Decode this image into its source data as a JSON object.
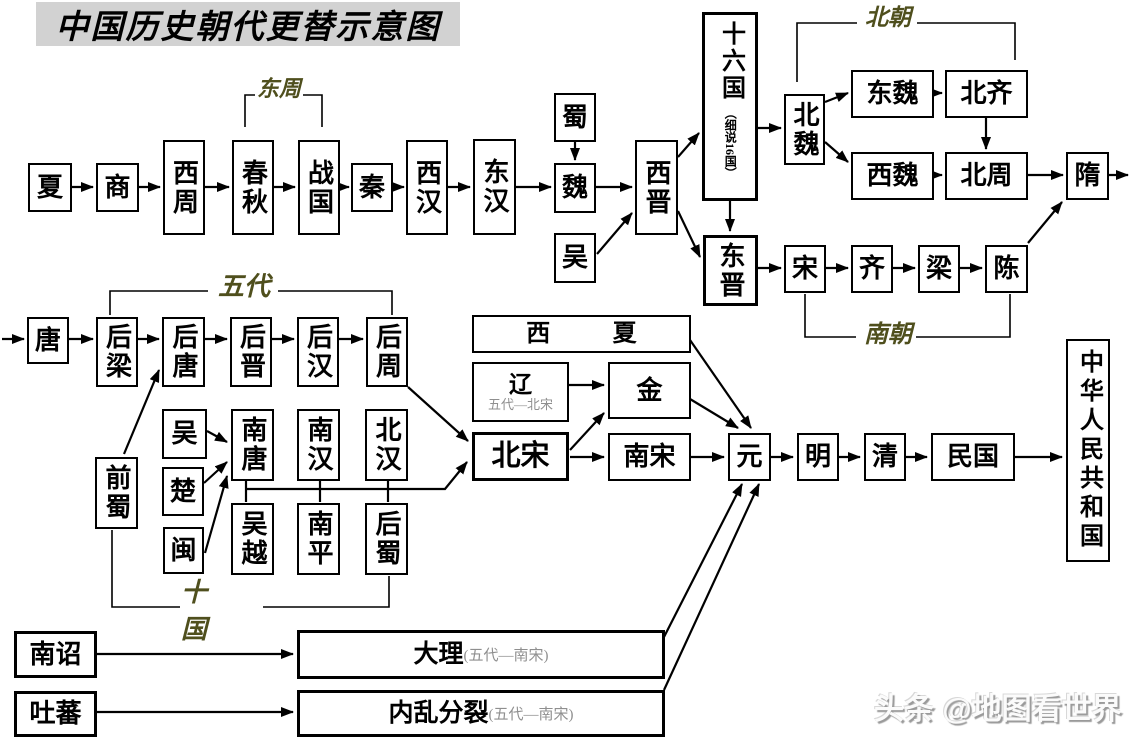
{
  "title": "中国历史朝代更替示意图",
  "watermark": "头条 @地图看世界",
  "era_labels": {
    "dongzhou": "东周",
    "beichao": "北朝",
    "nanchao": "南朝",
    "wudai": "五代",
    "shiguo": "十 国"
  },
  "nodes": {
    "xia": "夏",
    "shang": "商",
    "xizhou": "西周",
    "chunqiu": "春秋",
    "zhanguo": "战国",
    "qin": "秦",
    "xihan": "西汉",
    "donghan": "东汉",
    "shu": "蜀",
    "wei": "魏",
    "wu_sanguo": "吴",
    "xijin": "西晋",
    "shiliuguo": {
      "main": "十六国",
      "note": "（细说16国）"
    },
    "beiwei": "北魏",
    "dongwei": "东魏",
    "beiqi": "北齐",
    "xiwei": "西魏",
    "beizhou": "北周",
    "sui": "隋",
    "dongjin": "东晋",
    "song": "宋",
    "qi": "齐",
    "liang": "梁",
    "chen": "陈",
    "tang": "唐",
    "houliang": "后梁",
    "houtang": "后唐",
    "houjin": "后晋",
    "houhan": "后汉",
    "houzhou": "后周",
    "qianshu": "前蜀",
    "wu_shiguo": "吴",
    "chu": "楚",
    "min": "闽",
    "nantang": "南唐",
    "nanhan": "南汉",
    "beihan": "北汉",
    "wuyue": "吴越",
    "nanping": "南平",
    "houshu": "后蜀",
    "xixia": "西夏",
    "liao": {
      "main": "辽",
      "note": "五代—北宋"
    },
    "jin": "金",
    "beisong": "北宋",
    "nansong": "南宋",
    "yuan": "元",
    "ming": "明",
    "qing": "清",
    "minguo": "民国",
    "prc": "中华人民共和国",
    "nanzhao": "南诏",
    "tubo": "吐蕃",
    "dali": {
      "main": "大理",
      "note": "(五代—南宋)"
    },
    "neiluan": {
      "main": "内乱分裂",
      "note": "(五代—南宋)"
    }
  },
  "colors": {
    "border": "#000000",
    "era_label": "#4f4f1d",
    "note_gray": "#8f8f8f",
    "title_bg": "#d2d2d2"
  }
}
